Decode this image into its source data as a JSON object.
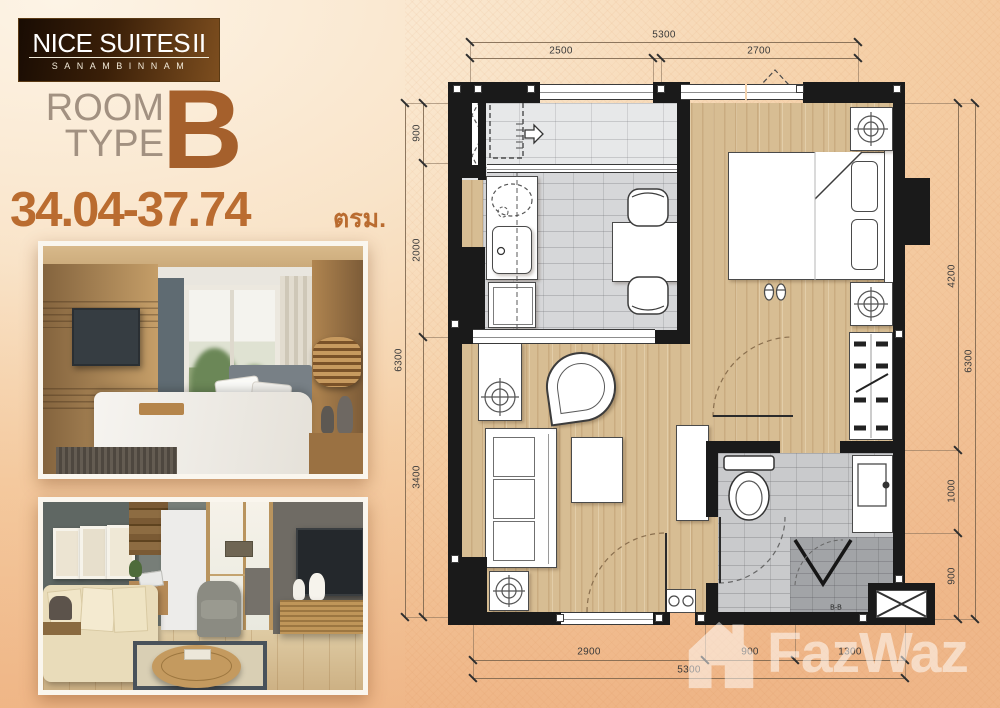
{
  "branding": {
    "logo": {
      "title": "NICE SUITES",
      "numeral": "II",
      "subtitle": "SANAMBINNAM"
    },
    "room_type": {
      "line1": "ROOM",
      "line2": "TYPE",
      "letter": "B"
    },
    "area": {
      "range": "34.04-37.74",
      "unit": "ตรม."
    }
  },
  "floor_plan": {
    "dimensions_mm": {
      "top": {
        "total": "5300",
        "segments": [
          "2500",
          "2700"
        ]
      },
      "bottom": {
        "total": "5300",
        "segments": [
          "2900",
          "900",
          "1300"
        ]
      },
      "left": {
        "total": "6300",
        "segments": [
          "900",
          "2000",
          "3400"
        ]
      },
      "right": {
        "total": "6300",
        "segments": [
          "4200",
          "1000",
          "900"
        ]
      }
    },
    "section_label": "B-B"
  },
  "watermark": {
    "text": "FazWaz"
  },
  "colors": {
    "accent": "#a5602c",
    "area_text": "#ba6c30",
    "logo_gradient_start": "#190c03",
    "logo_gradient_end": "#7d4e1f",
    "walls": "#1a1a1a",
    "wood_floor": "#d7bd93",
    "kitchen_tile": "#d6d7d9",
    "bath_tile": "#c9cacc",
    "page_bg": "#f5cfa6"
  }
}
